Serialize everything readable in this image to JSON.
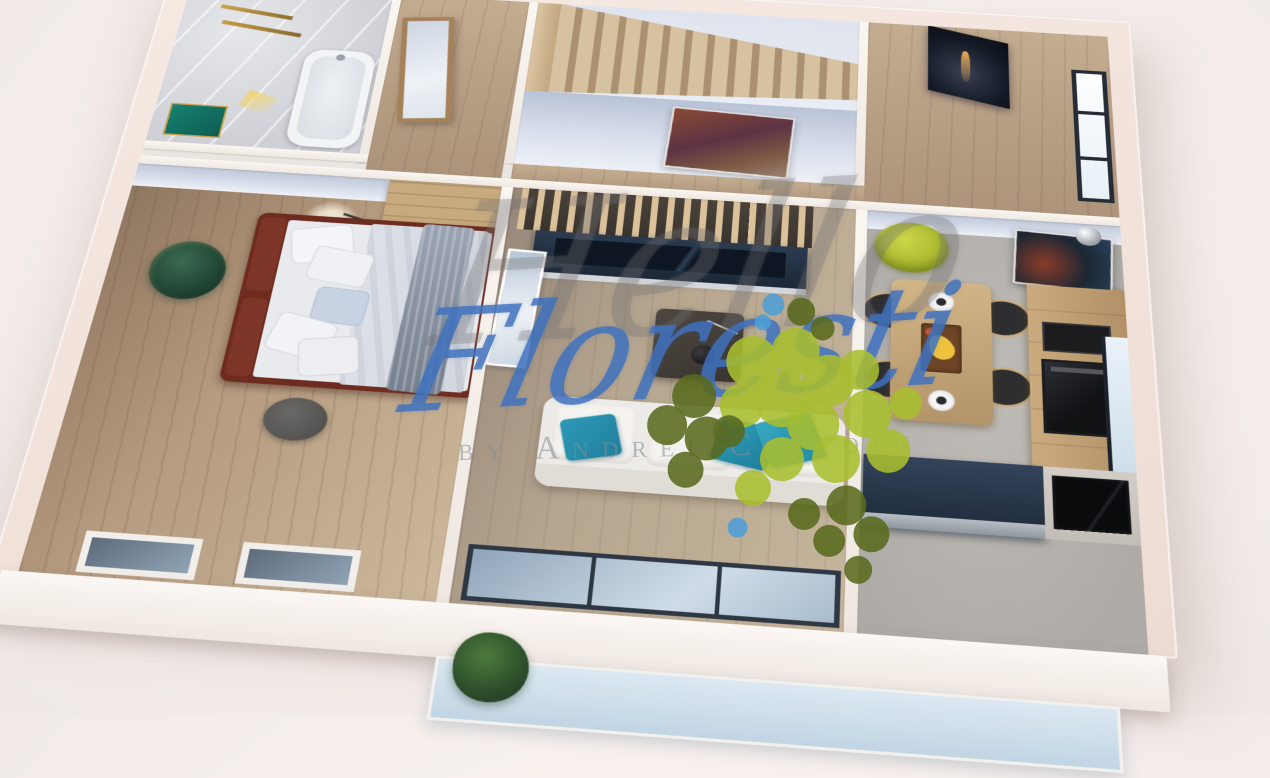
{
  "title": "3D apartment floor plan rendering",
  "watermark": {
    "brand_script": "Hello",
    "brand_name": "Floresti",
    "byline": "by Andrei Ciocoiu",
    "script_color": "#4072be",
    "byline_color": "#848c94",
    "tree_logo_colors": {
      "light_green": "#a8bd2f",
      "dark_olive": "#59691e",
      "blue_accent": "#4d9fd8"
    }
  },
  "scene": {
    "type": "isometric-3d-floor-plan",
    "rooms": [
      {
        "name": "bathroom",
        "items": [
          "bathtub",
          "towel-rails",
          "green-bath-mat"
        ]
      },
      {
        "name": "entry-hall",
        "items": [
          "framed-mirror"
        ]
      },
      {
        "name": "staircase",
        "items": [
          "wood-steps",
          "stringer",
          "abstract-red-painting"
        ]
      },
      {
        "name": "upper-hall-kitchen-wing",
        "items": [
          "eiffel-tower-picture",
          "window"
        ]
      },
      {
        "name": "bedroom",
        "items": [
          "double-bed",
          "pillows",
          "blue-pillow",
          "gray-throw",
          "round-wall-art",
          "floor-lamp",
          "wardrobe",
          "pouf",
          "south-windows"
        ]
      },
      {
        "name": "living-room",
        "items": [
          "slatted-partition",
          "tv-console",
          "leaning-canvas",
          "coffee-table",
          "white-sofa",
          "teal-pillows",
          "glass-doors"
        ]
      },
      {
        "name": "kitchen-dining",
        "items": [
          "green-armchair",
          "wall-art",
          "pendant-sphere",
          "dining-table",
          "four-chairs",
          "plates",
          "fruit-tray",
          "cabinet-column",
          "oven",
          "island-counter",
          "cooktop",
          "east-window"
        ]
      },
      {
        "name": "balcony",
        "items": [
          "white-slab",
          "glass-railing",
          "plant"
        ]
      }
    ],
    "palette": {
      "background": "#f5eeeb",
      "outer_wall": "#f0e0d8",
      "inner_wall_face": "#c6cfe0",
      "wood_floor": "#b59b7f",
      "marble": "#d8d9dd",
      "concrete_floor": "#b5b2ad",
      "bed_frame": "#6e2b1f",
      "sofa": "#edebe7",
      "teal_pillow": "#2794b0",
      "armchair_green": "#b4c232",
      "counter_navy": "#2c3b4e"
    }
  }
}
